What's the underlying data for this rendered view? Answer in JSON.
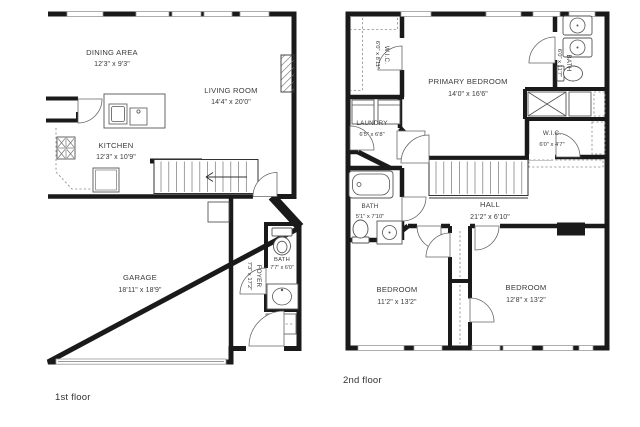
{
  "title": "Two-story residence floor plan",
  "colors": {
    "wall": "#1a1a1a",
    "fixture_line": "#555555",
    "label_text": "#3a3a3a",
    "background": "#ffffff"
  },
  "floors": {
    "first": {
      "label": "1st floor",
      "rooms": {
        "dining": {
          "name": "DINING AREA",
          "dims": "12'3\" x 9'3\""
        },
        "living": {
          "name": "LIVING ROOM",
          "dims": "14'4\" x 20'0\""
        },
        "kitchen": {
          "name": "KITCHEN",
          "dims": "12'3\" x 10'9\""
        },
        "garage": {
          "name": "GARAGE",
          "dims": "18'11\" x 18'9\""
        },
        "bath": {
          "name": "BATH",
          "dims": "7'7\" x 6'0\""
        },
        "foyer": {
          "name": "FOYER",
          "dims": "7'3\" x 17'2\""
        }
      }
    },
    "second": {
      "label": "2nd floor",
      "rooms": {
        "wic_left": {
          "name": "W.I.C.",
          "dims": "6'0\" x 8'11\""
        },
        "primary": {
          "name": "PRIMARY BEDROOM",
          "dims": "14'0\" x 16'6\""
        },
        "bath_top": {
          "name": "BATH",
          "dims": "6'0\" x 11'7\""
        },
        "laundry": {
          "name": "LAUNDRY",
          "dims": "6'5\" x 6'8\""
        },
        "wic_right": {
          "name": "W.I.C.",
          "dims": "6'0\" x 4'7\""
        },
        "bath_hall": {
          "name": "BATH",
          "dims": "5'1\" x 7'10\""
        },
        "hall": {
          "name": "HALL",
          "dims": "21'2\" x 6'10\""
        },
        "bedroom_left": {
          "name": "BEDROOM",
          "dims": "11'2\" x 13'2\""
        },
        "bedroom_right": {
          "name": "BEDROOM",
          "dims": "12'8\" x 13'2\""
        }
      }
    }
  }
}
